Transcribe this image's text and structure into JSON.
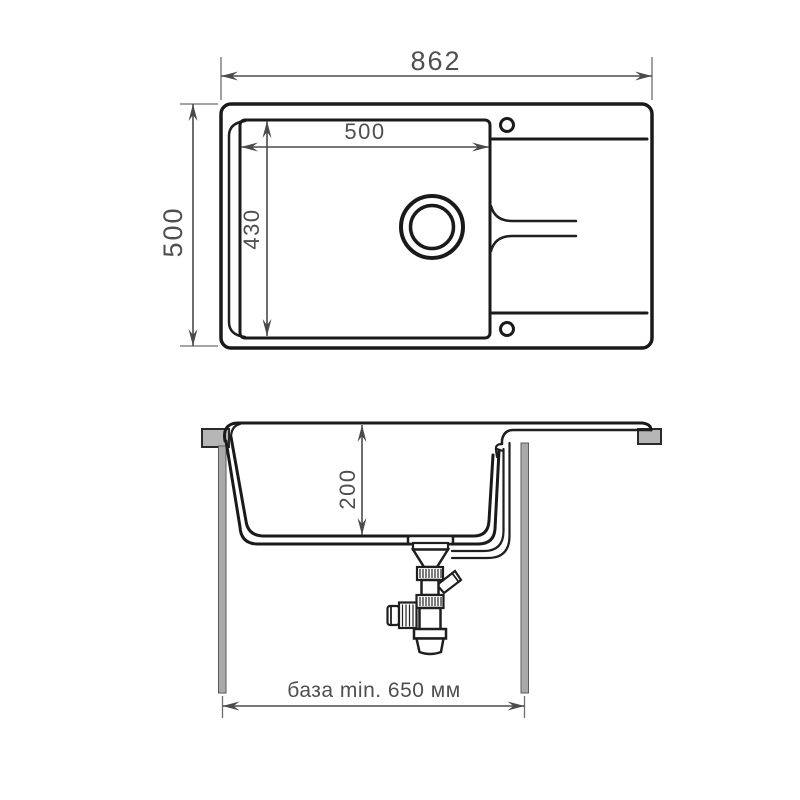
{
  "diagram": {
    "type": "sink-technical-drawing",
    "background": "#ffffff",
    "colors": {
      "line": "#1a1a1a",
      "dimension": "#4a4a4a",
      "label": "#4f4f4f",
      "countertop_fill": "#b6b6b6",
      "cabinet_fill": "#a9a9a9"
    },
    "top_view": {
      "overall_width": "862",
      "overall_depth": "500",
      "bowl_width": "500",
      "bowl_depth": "430"
    },
    "side_view": {
      "bowl_height": "200",
      "base_min": "база min. 650 мм"
    }
  }
}
